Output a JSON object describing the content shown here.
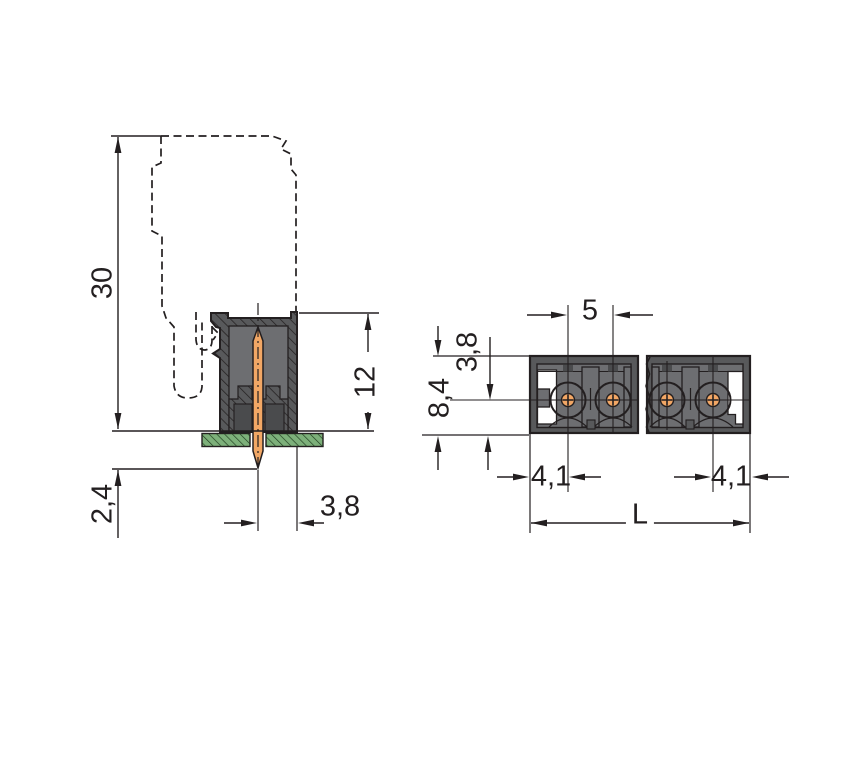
{
  "views": {
    "side_view": {
      "description": "connector side section view",
      "dimensions": {
        "overall_height": "30",
        "header_height": "12",
        "pin_protrusion": "2,4",
        "pin_to_edge": "3,8"
      }
    },
    "top_view": {
      "description": "connector mating-face view",
      "dimensions": {
        "pin_pitch": "5",
        "top_to_pin_center": "3,8",
        "overall_depth": "8,4",
        "first_pin_offset": "4,1",
        "last_pin_offset": "4,1",
        "overall_length": "L"
      }
    }
  },
  "colors": {
    "line": "#231f20",
    "housing_dark": "#58595b",
    "housing_mid": "#6d6e71",
    "housing_deep": "#4a4b4d",
    "pin_copper": "#f2a765",
    "pcb_green": "#7db07a",
    "white": "#ffffff"
  }
}
